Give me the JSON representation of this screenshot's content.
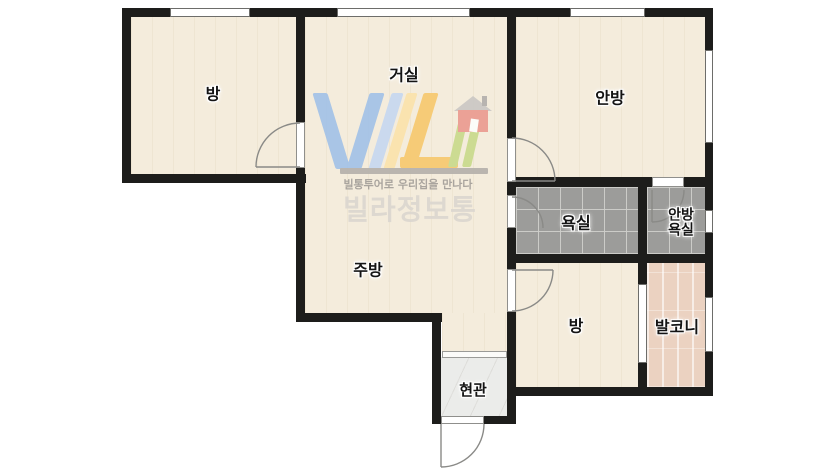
{
  "plan": {
    "type": "apartment-floor-plan",
    "rooms": {
      "room_left": "방",
      "living": "거실",
      "master": "안방",
      "bath": "욕실",
      "master_bath_line1": "안방",
      "master_bath_line2": "욕실",
      "kitchen": "주방",
      "room_bottom": "방",
      "balcony": "발코니",
      "entry": "현관"
    },
    "watermark": {
      "tagline": "빌통투어로 우리집을 만나다",
      "brand": "빌라정보통"
    },
    "colors": {
      "wall": "#1d1d1b",
      "floor": "#f4ecdc",
      "bath_tile": "#9c9c9a",
      "balcony_floor": "#ebd2c1",
      "entry_floor": "#ebecea",
      "logo_blue": "#a5c3e7",
      "logo_yellow": "#f7ca72",
      "logo_green": "#cadb8f",
      "logo_house_red": "#eb9e93",
      "logo_gray_text": "#a6a19b",
      "brand_gray_text": "#dcd7d0"
    }
  }
}
